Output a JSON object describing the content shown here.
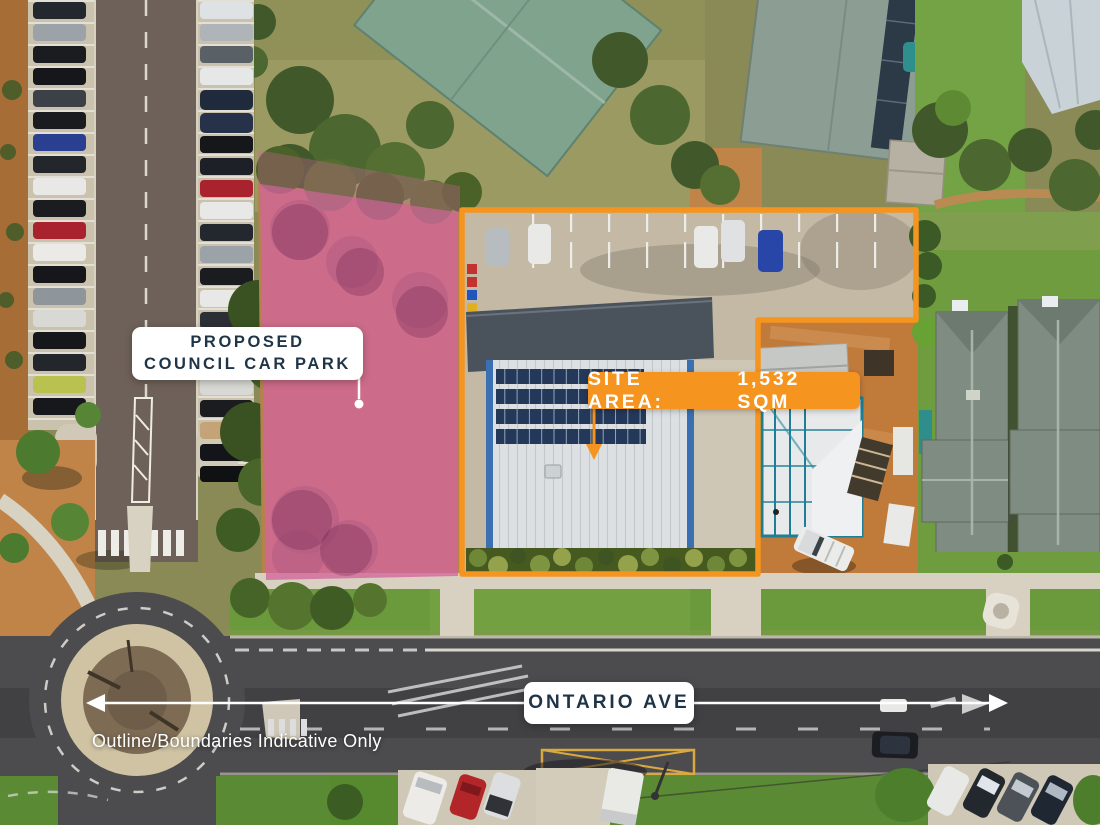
{
  "annotations": {
    "proposed_car_park": {
      "line1": "PROPOSED",
      "line2": "COUNCIL CAR PARK"
    },
    "site_area": {
      "label": "SITE AREA:",
      "value": "1,532 SQM"
    },
    "street_name": "ONTARIO AVE",
    "disclaimer": "Outline/Boundaries Indicative Only"
  },
  "icons": {
    "street_arrow": "double-headed-arrow",
    "site_area_pointer": "arrow-down",
    "car_park_pointer": "leader-line-with-dot"
  },
  "colors": {
    "boundary_orange": "#F5941F",
    "overlay_pink": "#D2659C",
    "label_navy": "#1F3547",
    "label_white": "#FFFFFF"
  }
}
